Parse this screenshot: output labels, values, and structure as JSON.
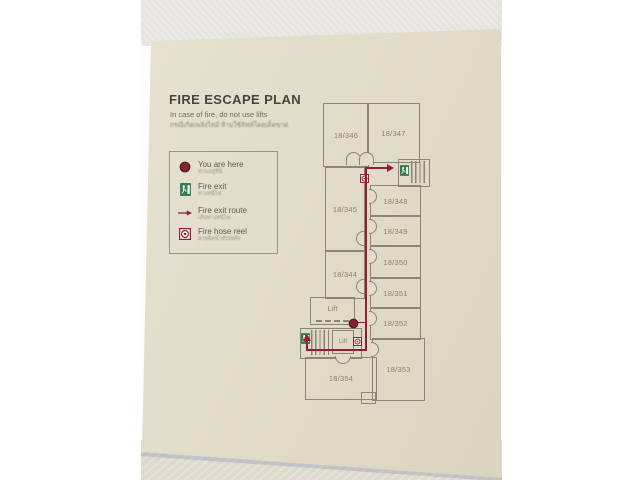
{
  "sign": {
    "title": "FIRE ESCAPE PLAN",
    "subtitle_en": "In case of fire, do not use lifts",
    "subtitle_th": "กรณีเกิดเพลิงไหม้ ห้ามใช้ลิฟท์โดยเด็ดขาด",
    "legend": [
      {
        "icon": "you-are-here-dot",
        "label": "You are here",
        "label_th": "ท่านอยู่ที่นี่"
      },
      {
        "icon": "fire-exit-sign",
        "label": "Fire exit",
        "label_th": "ทางหนีไฟ"
      },
      {
        "icon": "fire-exit-route-arrow",
        "label": "Fire exit route",
        "label_th": "เส้นทางหนีไฟ"
      },
      {
        "icon": "fire-hose-reel",
        "label": "Fire hose reel",
        "label_th": "สายฉีดน้ำดับเพลิง"
      }
    ],
    "floor_plan": {
      "rooms": [
        {
          "id": "346",
          "label": "18/346"
        },
        {
          "id": "347",
          "label": "18/347"
        },
        {
          "id": "345",
          "label": "18/345"
        },
        {
          "id": "344",
          "label": "18/344"
        },
        {
          "id": "348",
          "label": "18/348"
        },
        {
          "id": "349",
          "label": "18/349"
        },
        {
          "id": "350",
          "label": "18/350"
        },
        {
          "id": "351",
          "label": "18/351"
        },
        {
          "id": "352",
          "label": "18/352"
        },
        {
          "id": "353",
          "label": "18/353"
        },
        {
          "id": "354",
          "label": "18/354"
        }
      ],
      "lift_label_main": "Lift",
      "lift_label_small": "Lift"
    },
    "colors": {
      "route_red": "#8e2031",
      "exit_green": "#2e7c4f",
      "wall_gray": "#8b8478",
      "sign_background": "#e2dcc9"
    }
  }
}
